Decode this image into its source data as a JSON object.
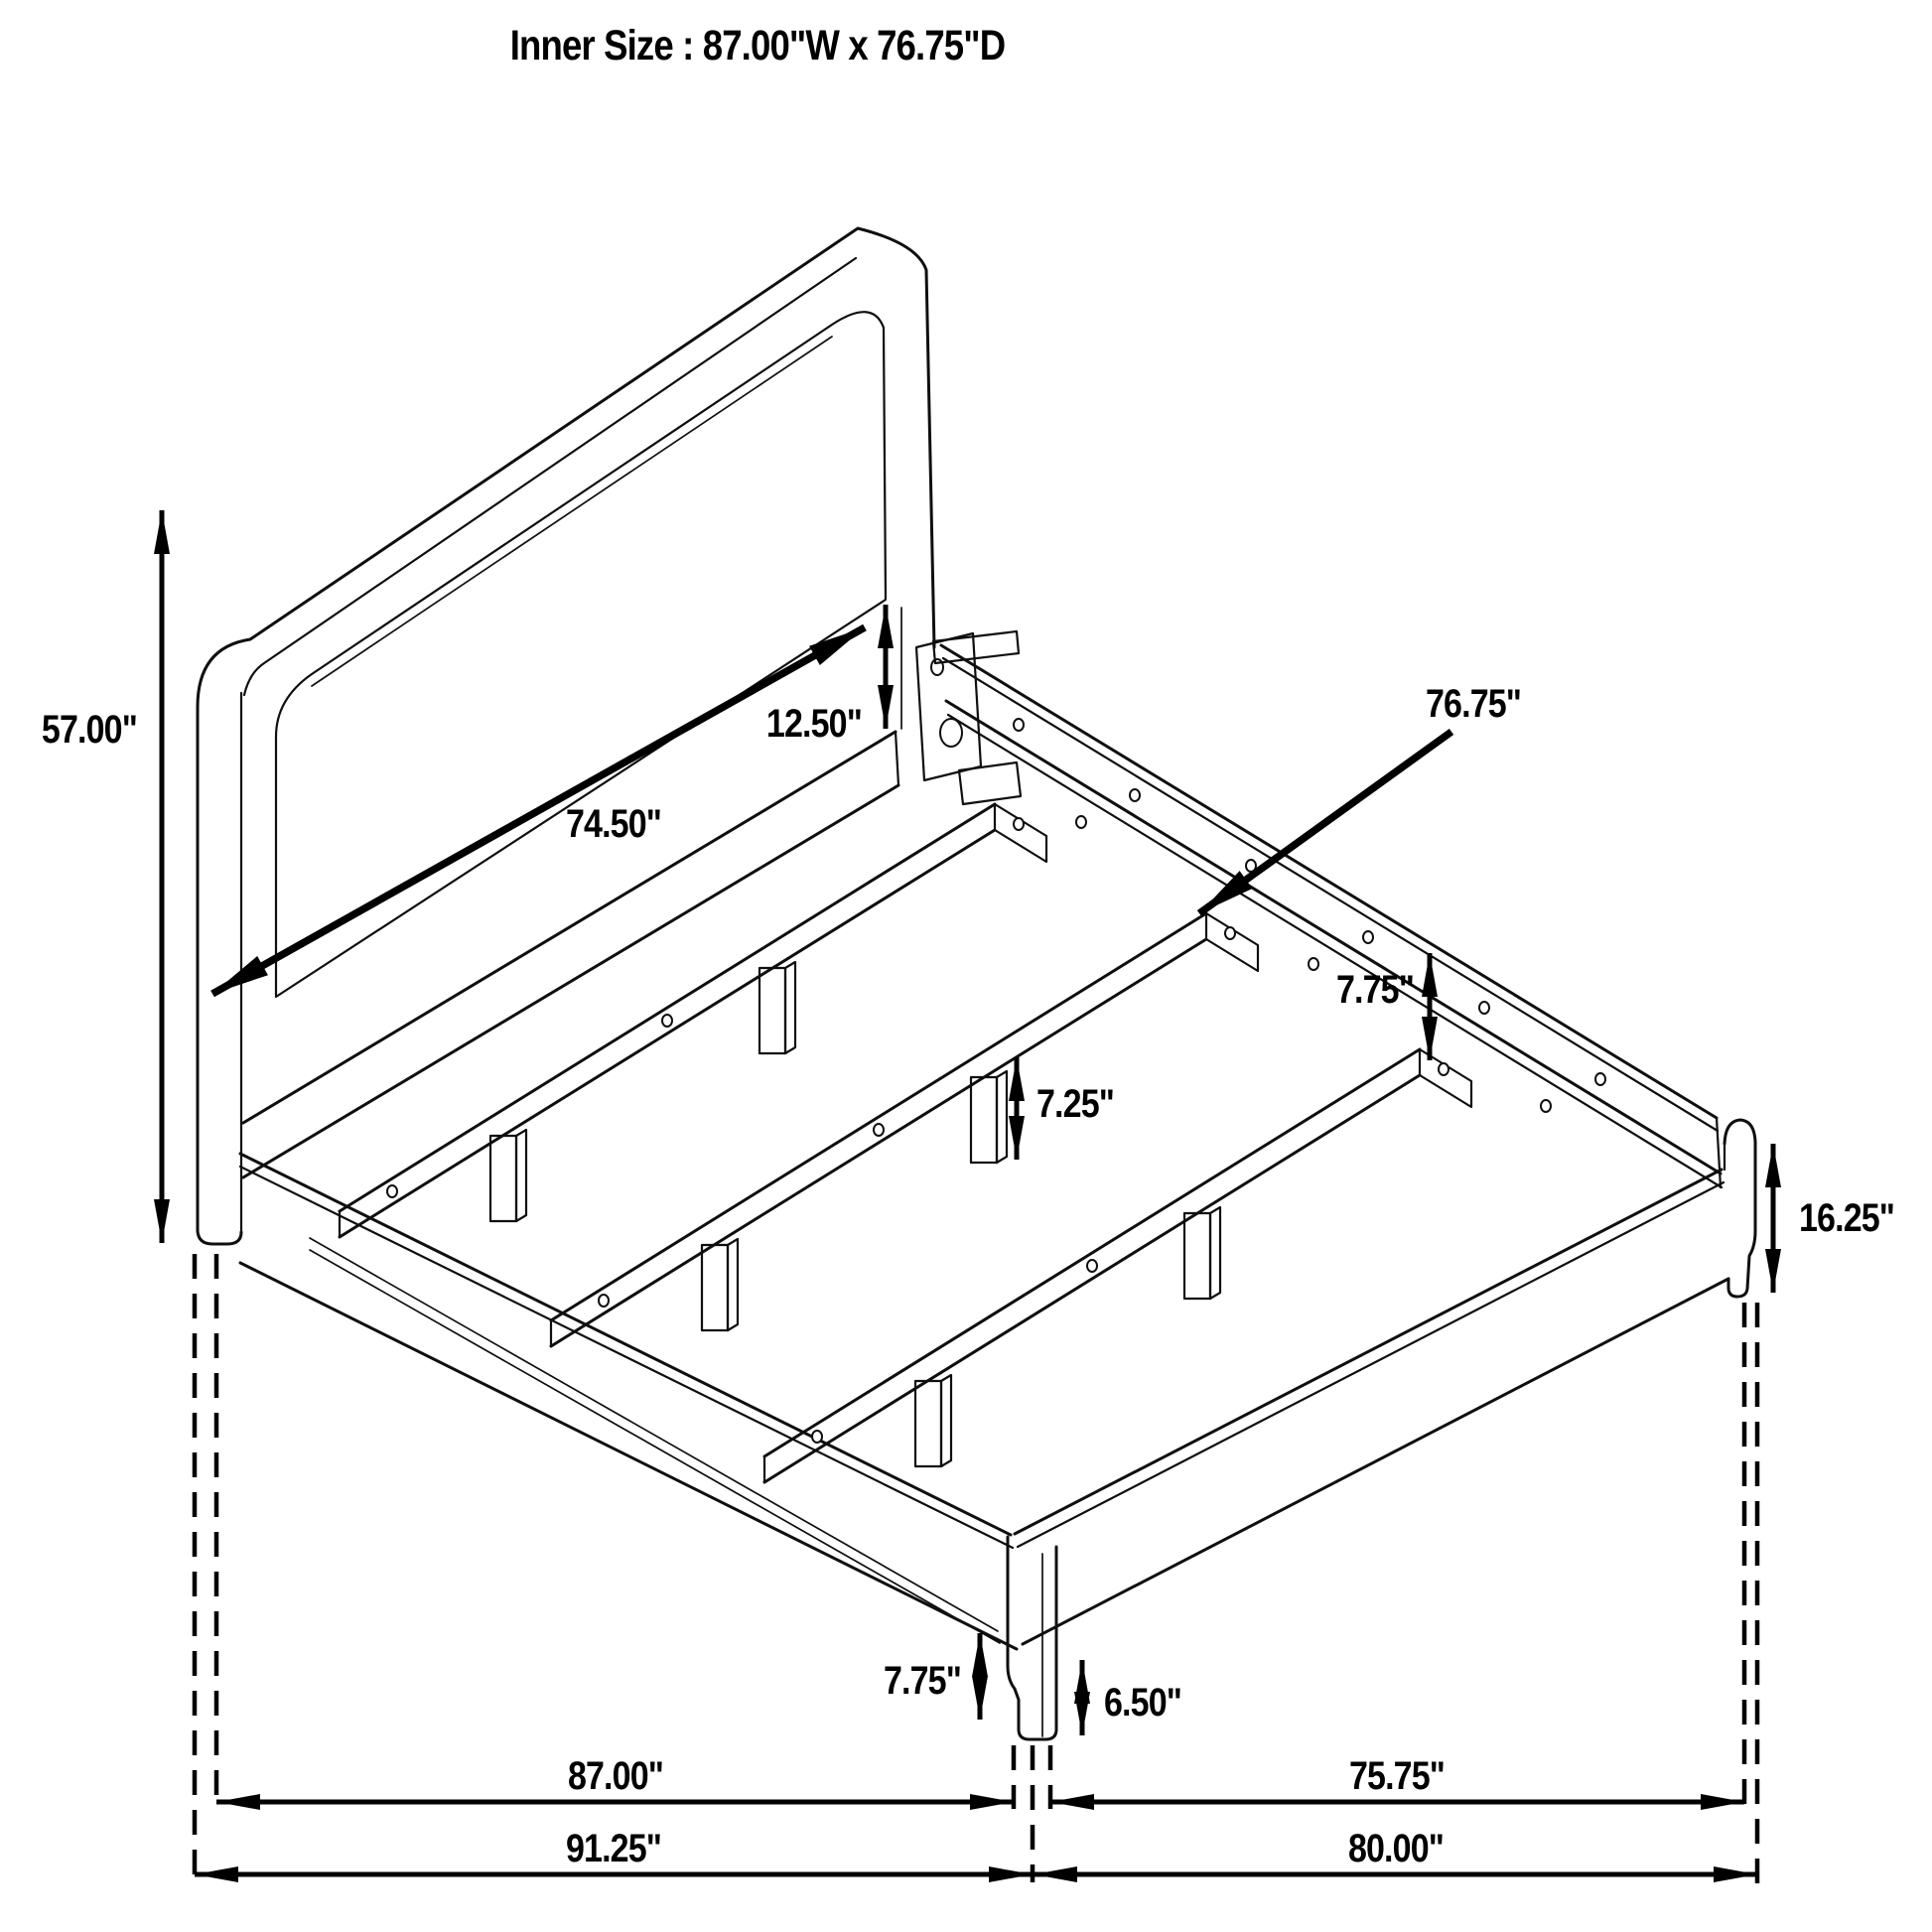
{
  "title": "Inner Size : 87.00\"W x 76.75\"D",
  "dimensions": {
    "headboard_height": {
      "label": "57.00\""
    },
    "panel_to_rail": {
      "label": "12.50\""
    },
    "headboard_inner_width": {
      "label": "74.50\""
    },
    "inner_depth_pointer": {
      "label": "76.75\""
    },
    "rail_to_slat": {
      "label": "7.75\""
    },
    "slat_leg_height": {
      "label": "7.25\""
    },
    "corner_post_height": {
      "label": "16.25\""
    },
    "front_leg_total_height": {
      "label": "7.75\""
    },
    "front_leg_height": {
      "label": "6.50\""
    },
    "inner_width": {
      "label": "87.00\""
    },
    "outer_width": {
      "label": "91.25\""
    },
    "inner_depth": {
      "label": "75.75\""
    },
    "outer_depth": {
      "label": "80.00\""
    }
  }
}
